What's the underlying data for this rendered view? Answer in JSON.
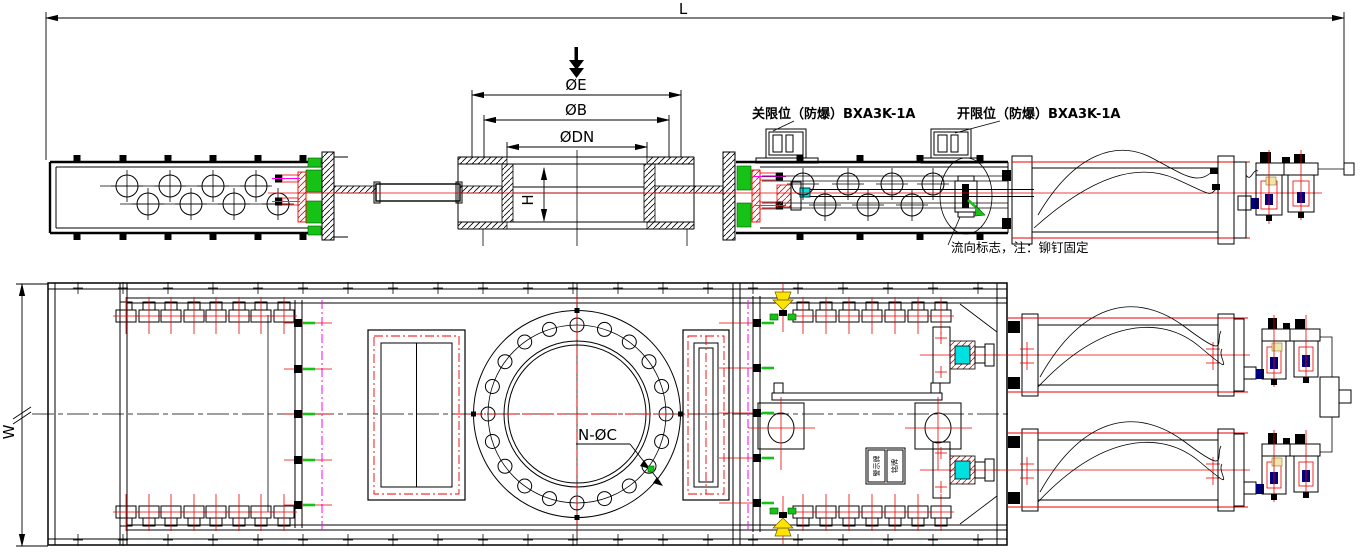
{
  "dims": {
    "L": "L",
    "E": "ØE",
    "B": "ØB",
    "DN": "ØDN",
    "H": "H",
    "W": "W",
    "NC": "N-ØC"
  },
  "labels": {
    "close_limit": "关限位（防爆）BXA3K-1A",
    "open_limit": "开限位（防爆）BXA3K-1A",
    "flow_note": "流向标志，注：铆钉固定",
    "warning_plate": "警示牌",
    "name_plate": "铭牌"
  },
  "colors": {
    "line": "#000000",
    "red": "#ee0000",
    "green": "#17c217",
    "magenta": "#ff00ff",
    "cyan": "#00e0e0",
    "yellow": "#ffe400",
    "pale_yellow": "#efe6ac",
    "navy": "#000080"
  }
}
